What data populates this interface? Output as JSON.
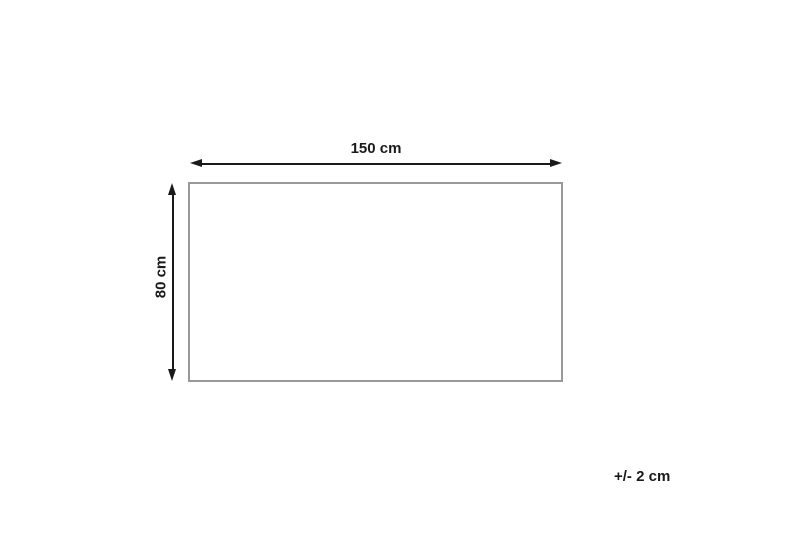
{
  "diagram": {
    "title": "product-dimension-diagram",
    "width_label": "150 cm",
    "height_label": "80 cm",
    "tolerance_label": "+/- 2 cm",
    "colors": {
      "arrow": "#1a1a1a",
      "text": "#1a1a1a",
      "rect_border": "#999999",
      "background": "#ffffff"
    }
  }
}
